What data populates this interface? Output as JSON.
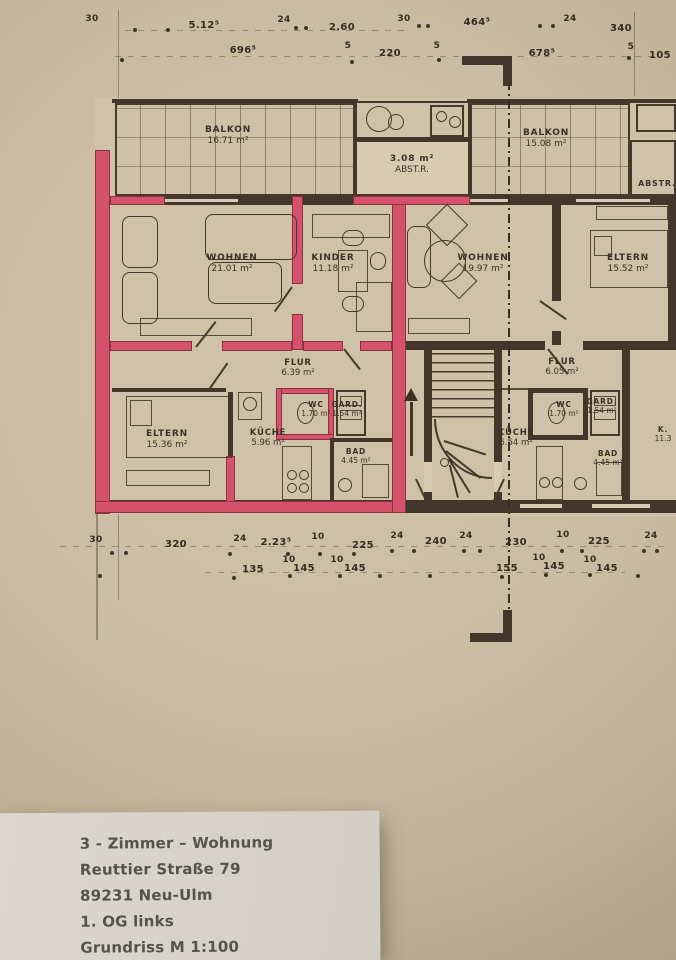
{
  "colors": {
    "paper": "#cabca3",
    "ink": "#43362a",
    "highlight": "#d4526b",
    "paper_white": "#d8d4ca"
  },
  "plan": {
    "rooms": [
      {
        "name": "balkon-left",
        "lines": [
          "BALKON",
          "16.71 m²"
        ],
        "x": 228,
        "y": 136,
        "size": 9
      },
      {
        "name": "abstellraum",
        "lines": [
          "3.08 m²",
          "ABST.R."
        ],
        "x": 412,
        "y": 165,
        "size": 9
      },
      {
        "name": "balkon-right",
        "lines": [
          "BALKON",
          "15.08 m²"
        ],
        "x": 546,
        "y": 139,
        "size": 9
      },
      {
        "name": "abstellraum-neighbor",
        "lines": [
          "ABSTR."
        ],
        "x": 657,
        "y": 184,
        "size": 8
      },
      {
        "name": "wohnen-left",
        "lines": [
          "WOHNEN",
          "21.01 m²"
        ],
        "x": 232,
        "y": 264,
        "size": 9
      },
      {
        "name": "kinder",
        "lines": [
          "KINDER",
          "11.18 m²"
        ],
        "x": 333,
        "y": 264,
        "size": 9
      },
      {
        "name": "wohnen-right",
        "lines": [
          "WOHNEN",
          "19.97 m²"
        ],
        "x": 483,
        "y": 264,
        "size": 9
      },
      {
        "name": "eltern-right",
        "lines": [
          "ELTERN",
          "15.52 m²"
        ],
        "x": 628,
        "y": 264,
        "size": 9
      },
      {
        "name": "flur-left",
        "lines": [
          "FLUR",
          "6.39 m²"
        ],
        "x": 298,
        "y": 368,
        "size": 8.5
      },
      {
        "name": "wc-left",
        "lines": [
          "WC",
          "1.70 m²"
        ],
        "x": 316,
        "y": 409,
        "size": 7.5
      },
      {
        "name": "gard-left",
        "lines": [
          "GARD.",
          "1.54 m²"
        ],
        "x": 347,
        "y": 409,
        "size": 7.5
      },
      {
        "name": "kueche-left",
        "lines": [
          "KÜCHE",
          "5.96 m²"
        ],
        "x": 268,
        "y": 438,
        "size": 8.5
      },
      {
        "name": "bad-left",
        "lines": [
          "BAD",
          "4.45 m²"
        ],
        "x": 356,
        "y": 456,
        "size": 7.5
      },
      {
        "name": "eltern-left",
        "lines": [
          "ELTERN",
          "15.36 m²"
        ],
        "x": 167,
        "y": 440,
        "size": 9
      },
      {
        "name": "flur-right",
        "lines": [
          "FLUR",
          "6.05 m²"
        ],
        "x": 562,
        "y": 367,
        "size": 8.5
      },
      {
        "name": "wc-right",
        "lines": [
          "WC",
          "1.70 m²"
        ],
        "x": 564,
        "y": 409,
        "size": 7.5
      },
      {
        "name": "gard-right",
        "lines": [
          "GARD.",
          "1.54 m²"
        ],
        "x": 602,
        "y": 406,
        "size": 7.5
      },
      {
        "name": "kueche-right",
        "lines": [
          "KÜCHE",
          "6.54 m²"
        ],
        "x": 516,
        "y": 438,
        "size": 8.5
      },
      {
        "name": "bad-right",
        "lines": [
          "BAD",
          "4.45 m²"
        ],
        "x": 608,
        "y": 458,
        "size": 7.5
      },
      {
        "name": "kind-right-cut",
        "lines": [
          "K.",
          "11.3"
        ],
        "x": 663,
        "y": 434,
        "size": 7.5
      }
    ],
    "dims_top": [
      {
        "t": "30",
        "x": 92,
        "y": 14
      },
      {
        "t": "5.12⁵",
        "x": 204,
        "y": 20
      },
      {
        "t": "24",
        "x": 284,
        "y": 15
      },
      {
        "t": "2.60",
        "x": 342,
        "y": 22
      },
      {
        "t": "30",
        "x": 404,
        "y": 14
      },
      {
        "t": "464⁵",
        "x": 477,
        "y": 17
      },
      {
        "t": "24",
        "x": 570,
        "y": 14
      },
      {
        "t": "340",
        "x": 621,
        "y": 23
      },
      {
        "t": "696⁵",
        "x": 243,
        "y": 45
      },
      {
        "t": "5",
        "x": 348,
        "y": 41
      },
      {
        "t": "220",
        "x": 390,
        "y": 48
      },
      {
        "t": "5",
        "x": 437,
        "y": 41
      },
      {
        "t": "678⁵",
        "x": 542,
        "y": 48
      },
      {
        "t": "5",
        "x": 631,
        "y": 42
      },
      {
        "t": "105",
        "x": 660,
        "y": 50
      }
    ],
    "dims_bottom": [
      {
        "t": "30",
        "x": 96,
        "y": 535
      },
      {
        "t": "320",
        "x": 176,
        "y": 539
      },
      {
        "t": "24",
        "x": 240,
        "y": 534
      },
      {
        "t": "2.23⁵",
        "x": 276,
        "y": 537
      },
      {
        "t": "10",
        "x": 318,
        "y": 532
      },
      {
        "t": "225",
        "x": 363,
        "y": 540
      },
      {
        "t": "24",
        "x": 397,
        "y": 531
      },
      {
        "t": "240",
        "x": 436,
        "y": 536
      },
      {
        "t": "24",
        "x": 466,
        "y": 531
      },
      {
        "t": "230",
        "x": 516,
        "y": 537
      },
      {
        "t": "10",
        "x": 563,
        "y": 530
      },
      {
        "t": "225",
        "x": 599,
        "y": 536
      },
      {
        "t": "24",
        "x": 651,
        "y": 531
      },
      {
        "t": "135",
        "x": 253,
        "y": 564
      },
      {
        "t": "10",
        "x": 289,
        "y": 555
      },
      {
        "t": "145",
        "x": 304,
        "y": 563
      },
      {
        "t": "10",
        "x": 337,
        "y": 555
      },
      {
        "t": "145",
        "x": 355,
        "y": 563
      },
      {
        "t": "155",
        "x": 507,
        "y": 563
      },
      {
        "t": "10",
        "x": 539,
        "y": 553
      },
      {
        "t": "145",
        "x": 554,
        "y": 561
      },
      {
        "t": "10",
        "x": 590,
        "y": 555
      },
      {
        "t": "145",
        "x": 607,
        "y": 563
      }
    ]
  },
  "footer": {
    "lines": [
      "3 - Zimmer – Wohnung",
      "Reuttier Straße 79",
      "89231 Neu-Ulm",
      "1. OG links",
      "Grundriss M 1:100"
    ]
  }
}
